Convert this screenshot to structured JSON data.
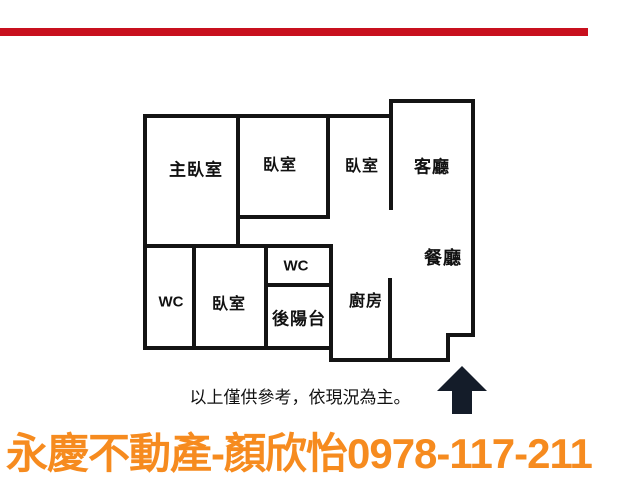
{
  "page": {
    "background_color": "#ffffff",
    "top_bar_color": "#c8101e"
  },
  "floor_plan": {
    "wall_color": "#141414",
    "rooms": [
      {
        "id": "master-bedroom",
        "label": "主臥室"
      },
      {
        "id": "bedroom-2",
        "label": "臥室"
      },
      {
        "id": "bedroom-3",
        "label": "臥室"
      },
      {
        "id": "living-room",
        "label": "客廳"
      },
      {
        "id": "dining-room",
        "label": "餐廳"
      },
      {
        "id": "wc-upper",
        "label": "WC"
      },
      {
        "id": "back-balcony",
        "label": "後陽台"
      },
      {
        "id": "wc-left",
        "label": "WC"
      },
      {
        "id": "bedroom-4",
        "label": "臥室"
      },
      {
        "id": "kitchen",
        "label": "廚房"
      }
    ],
    "direction_arrow": {
      "icon": "up-arrow-icon",
      "color": "#141c29"
    }
  },
  "caption": {
    "text": "以上僅供參考，依現況為主。"
  },
  "contact": {
    "brand": "永慶不動產",
    "agent": "顏欣怡",
    "phone": "0978-117-211",
    "display_text": "永慶不動產-顏欣怡0978-117-211",
    "color": "#f68b1f"
  }
}
